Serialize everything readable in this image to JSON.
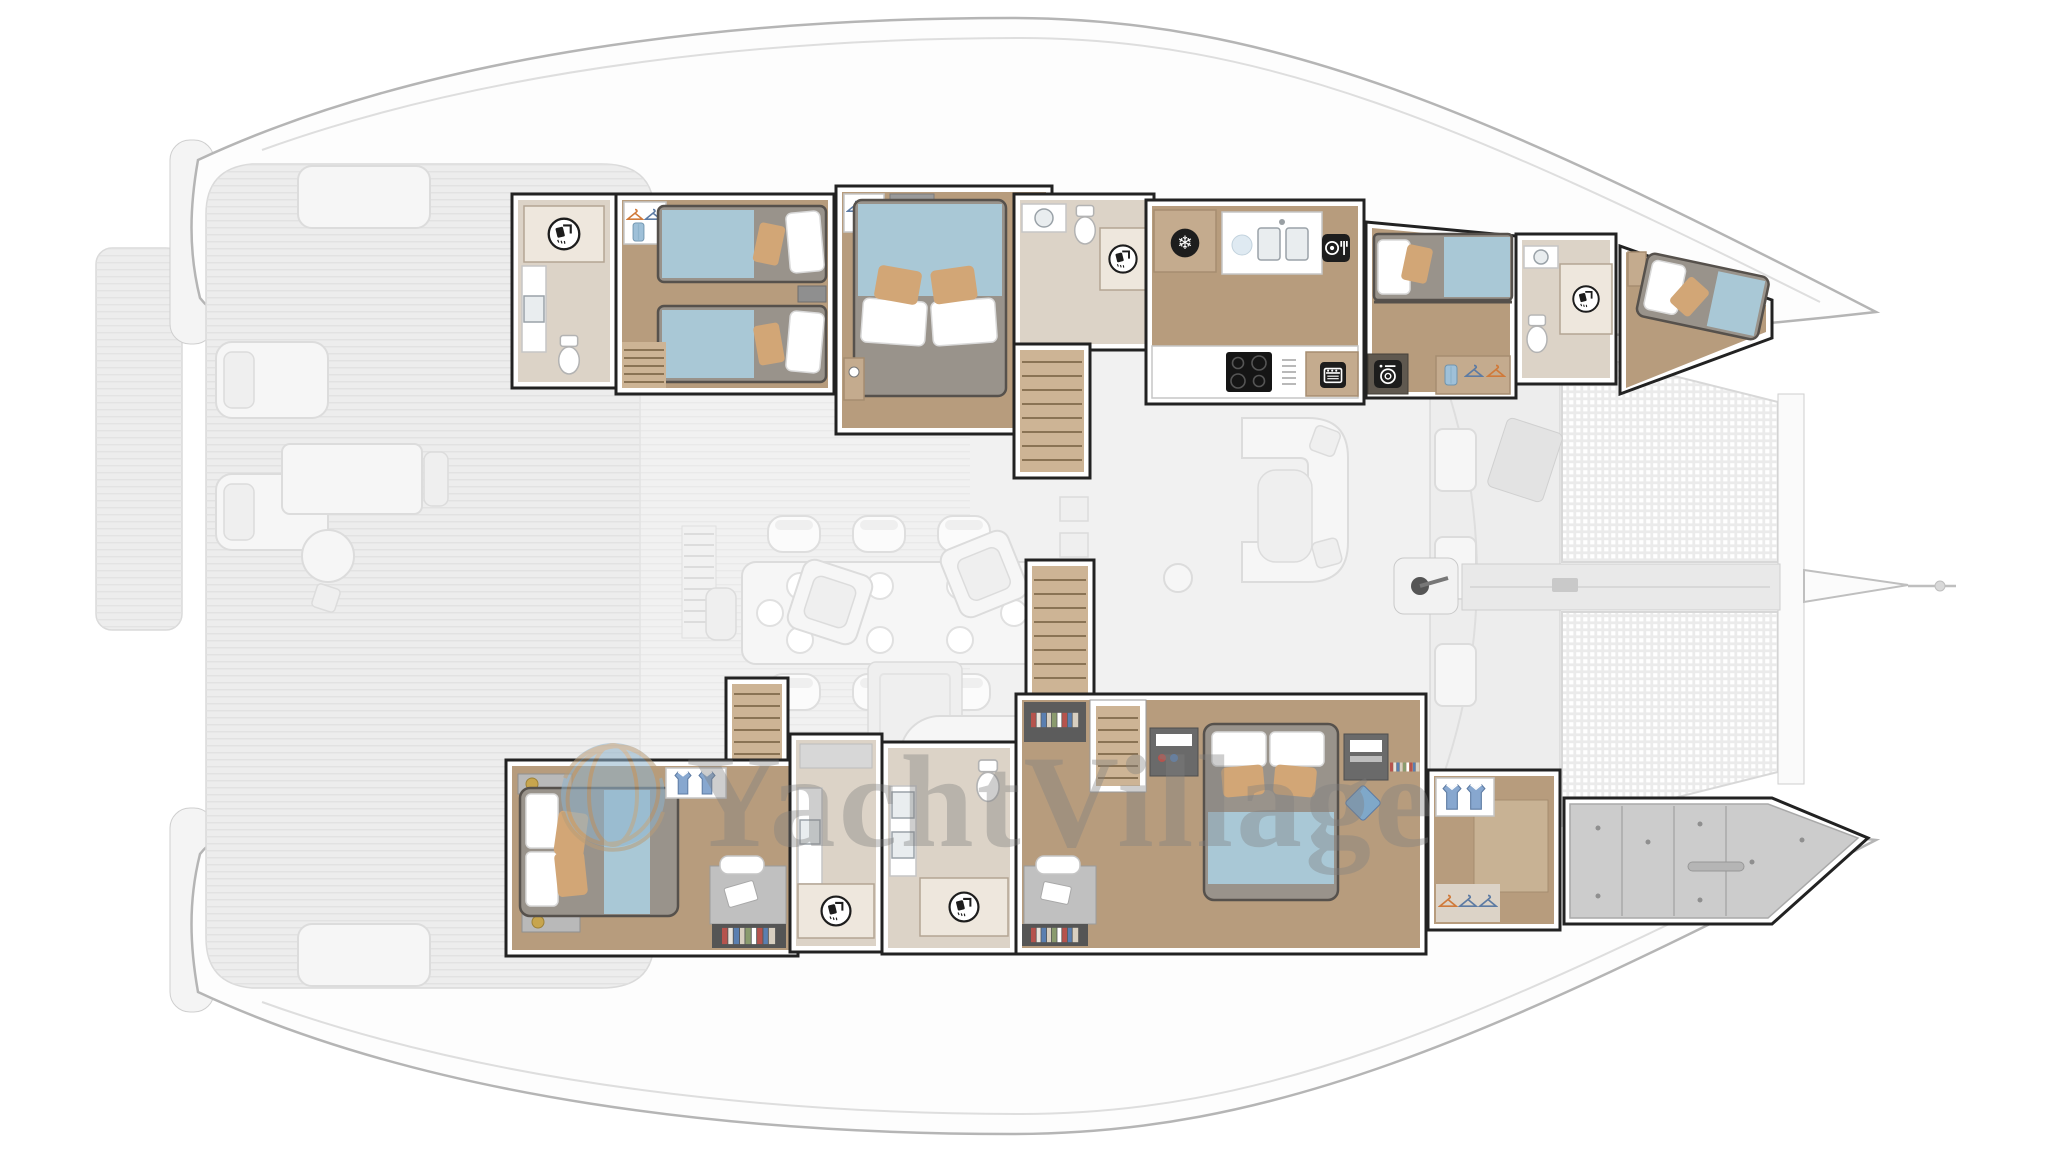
{
  "watermark": {
    "text": "YachtVillage",
    "logo": "globe-icon"
  },
  "icons": {
    "freezer_glyph": "❄",
    "list": [
      "shower-icon",
      "freezer-icon",
      "cutlery-icon",
      "oven-icon",
      "washing-machine-icon",
      "hanger-icon",
      "shirt-icon",
      "towel-icon",
      "cooktop",
      "sink",
      "toilet",
      "windlass-icon"
    ]
  },
  "colors": {
    "background": "#ffffff",
    "hull_outline": "#b5b5b5",
    "faded_deck": "#ededed",
    "faded_stroke": "#dadada",
    "faded_furniture": "#f6f6f6",
    "salon_floor": "#f1f1f1",
    "room_outline": "#222222",
    "wall_white": "#ffffff",
    "wood_floor": "#b79c7d",
    "wood_dark": "#8a7354",
    "bathroom_floor": "#dcd3c7",
    "shower_box": "#eee7dd",
    "mattress_gray": "#99938b",
    "blanket_blue": "#a9c8d6",
    "pillow_white": "#ffffff",
    "cushion_tan": "#d2a676",
    "cabinet_tan": "#c4ab8e",
    "icon_black": "#1d1d1d",
    "storage_gray": "#cccccc",
    "mesh_gray": "#ebebeb",
    "watermark_gray": "#808080",
    "globe_blue": "#8fb3cc",
    "globe_line": "#b89d79",
    "towel_blue": "#9fc0d8",
    "shirt_blue": "#87a7cf",
    "hanger_orange": "#d07a3a",
    "hanger_blue": "#5d7ba3",
    "brass": "#c7a54e"
  },
  "plan": {
    "type": "catamaran-yacht-deck-plan",
    "view": "top-down",
    "bow_direction": "right",
    "decks": [
      "swim-platform",
      "aft-cockpit",
      "main-salon",
      "foredeck-trampoline",
      "bowsprit"
    ],
    "rooms": [
      {
        "id": "port-aft-head",
        "type": "bathroom",
        "fixtures": [
          "shower",
          "sink",
          "toilet"
        ]
      },
      {
        "id": "port-aft-twin-cabin",
        "type": "cabin",
        "beds": "2 single beds",
        "features": [
          "wardrobe",
          "stairs"
        ]
      },
      {
        "id": "port-mid-double-cabin",
        "type": "cabin",
        "beds": "1 double bed",
        "features": [
          "wardrobe",
          "nightstands"
        ]
      },
      {
        "id": "port-companionway",
        "type": "stairs"
      },
      {
        "id": "port-forward-head",
        "type": "bathroom",
        "fixtures": [
          "shower",
          "sink",
          "toilet"
        ]
      },
      {
        "id": "galley",
        "type": "galley",
        "fixtures": [
          "freezer",
          "double-sink",
          "dishwasher",
          "cooktop",
          "oven"
        ]
      },
      {
        "id": "port-forward-bunk-cabin",
        "type": "cabin",
        "beds": "bunk beds",
        "features": [
          "washing-machine",
          "wardrobe"
        ]
      },
      {
        "id": "port-bow-head",
        "type": "bathroom",
        "fixtures": [
          "shower",
          "sink",
          "toilet"
        ]
      },
      {
        "id": "port-forepeak-crew-cabin",
        "type": "cabin",
        "beds": "1 single bed"
      },
      {
        "id": "starboard-aft-cabin",
        "type": "cabin",
        "beds": "1 double bed",
        "features": [
          "desk",
          "bookshelf",
          "drawers"
        ]
      },
      {
        "id": "starboard-aft-stairs",
        "type": "stairs"
      },
      {
        "id": "starboard-aft-head",
        "type": "bathroom",
        "fixtures": [
          "shower",
          "sink"
        ]
      },
      {
        "id": "starboard-mid-head",
        "type": "bathroom",
        "fixtures": [
          "shower",
          "double-sink",
          "toilet"
        ]
      },
      {
        "id": "owner-suite",
        "type": "cabin",
        "beds": "1 double bed",
        "features": [
          "desk",
          "tv-console",
          "bookshelves",
          "stairs"
        ]
      },
      {
        "id": "owner-suite-entry-stairs",
        "type": "stairs"
      },
      {
        "id": "starboard-forepeak-dressing",
        "type": "wardrobe"
      },
      {
        "id": "starboard-bow-storage",
        "type": "storage"
      }
    ]
  }
}
